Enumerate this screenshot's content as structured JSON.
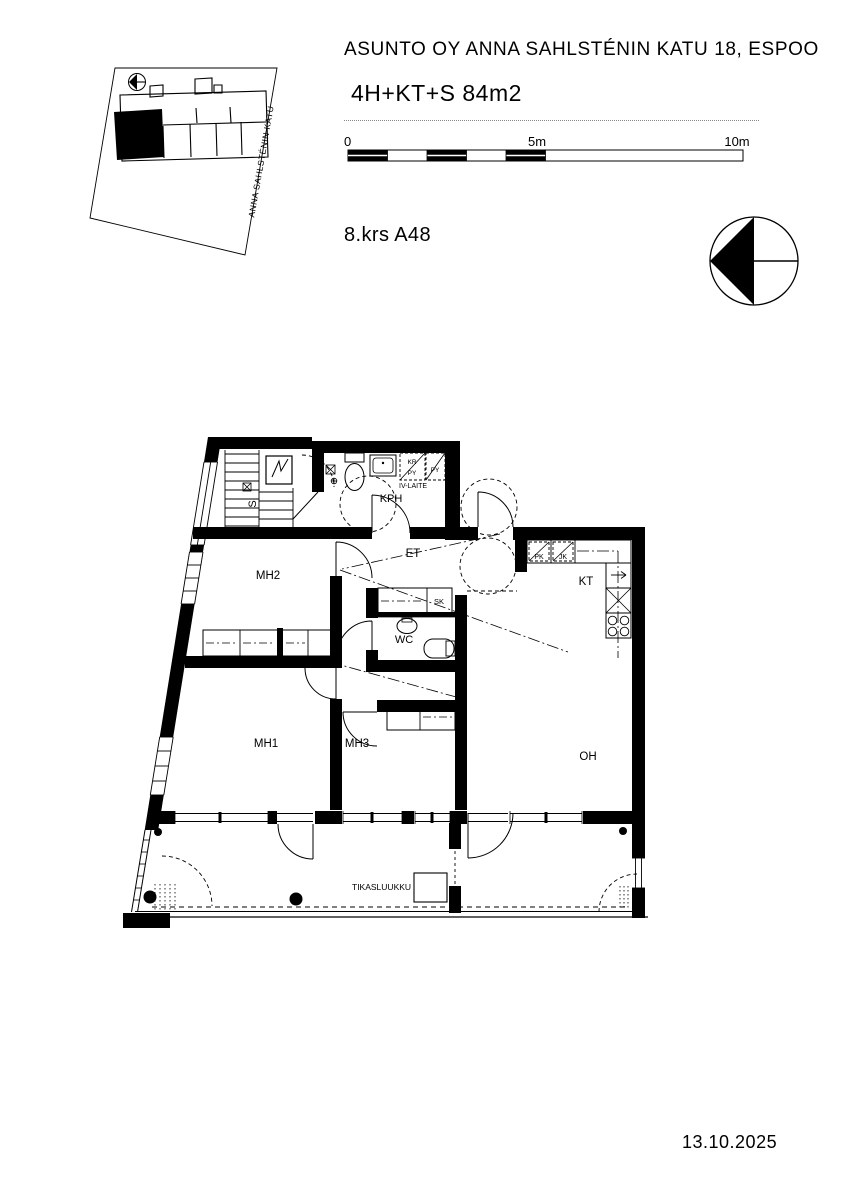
{
  "header": {
    "title": "ASUNTO OY ANNA SAHLSTÉNIN KATU 18, ESPOO",
    "apartment_type": "4H+KT+S 84m2",
    "floor_label": "8.krs A48"
  },
  "scale_bar": {
    "zero": "0",
    "five": "5m",
    "ten": "10m"
  },
  "site_plan": {
    "street": "ANNA SAHLSTÉNIN KATU"
  },
  "plan": {
    "rooms": {
      "sauna": "S",
      "bathroom": "KPH",
      "hall": "ET",
      "wc": "WC",
      "closet": "SK",
      "kitchen": "KT",
      "bedroom1": "MH1",
      "bedroom2": "MH2",
      "bedroom3": "MH3",
      "living": "OH"
    },
    "appliances": {
      "iv_unit": "IV-LAITE",
      "dryer": "KR",
      "washer1": "PY",
      "washer2": "PY",
      "freezer": "PK",
      "fridge": "JK"
    },
    "balcony_hatch": "TIKASLUUKKU"
  },
  "footer": {
    "date": "13.10.2025"
  },
  "colors": {
    "ink": "#000000",
    "paper": "#ffffff"
  }
}
